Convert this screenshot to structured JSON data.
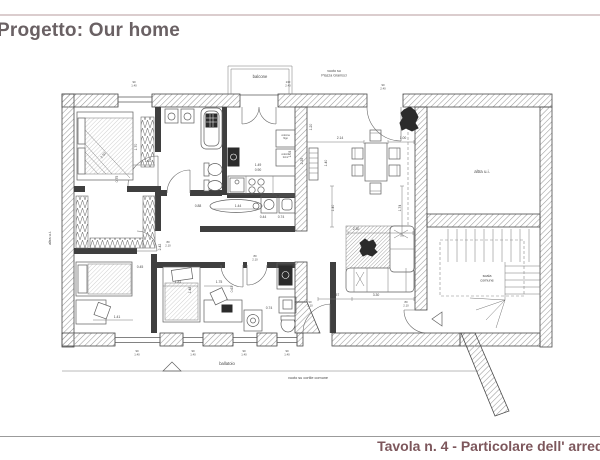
{
  "header": {
    "title": "Progetto: Our home"
  },
  "footer": {
    "title": "Tavola n. 4 - Particolare dell' arredo"
  },
  "colors": {
    "header_text": "#6a6164",
    "header_rule": "#dbcdce",
    "footer_text": "#7d575c",
    "footer_rule": "#9b9b9b",
    "plan_line": "#4a4a4a",
    "wall_fill": "#3f3f3f"
  },
  "plan": {
    "room_labels": [
      {
        "id": "balcone",
        "text": "balcone",
        "x": 260,
        "y": 78,
        "size": 4.2
      },
      {
        "id": "piazza-void",
        "text": "vuoto su\nPiazza Gramsci",
        "x": 334,
        "y": 72,
        "size": 3.6
      },
      {
        "id": "altra-ui",
        "text": "altra u.i.",
        "x": 482,
        "y": 173,
        "size": 4.4
      },
      {
        "id": "scala-comune",
        "text": "scala\ncomune",
        "x": 487,
        "y": 277,
        "size": 3.8
      },
      {
        "id": "ballatoio",
        "text": "ballatoio",
        "x": 227,
        "y": 365,
        "size": 4.2
      },
      {
        "id": "cortile-void",
        "text": "vuoto su cortile comune",
        "x": 308,
        "y": 379,
        "size": 3.8
      },
      {
        "id": "altra-ui-left",
        "text": "altra u.i.",
        "x": 51,
        "y": 238,
        "size": 3.8,
        "rot": -90
      },
      {
        "id": "colonna-frigo",
        "text": "colonna\nfrigo",
        "x": 285.5,
        "y": 136,
        "size": 2.4
      },
      {
        "id": "colonna-forno",
        "text": "colonna\nforno",
        "x": 285.5,
        "y": 155,
        "size": 2.4
      }
    ],
    "dimensions": [
      {
        "text": "2.50",
        "x": 104,
        "y": 156,
        "rot": -50
      },
      {
        "text": "1.70",
        "x": 137,
        "y": 147,
        "rot": -90
      },
      {
        "text": "0.75",
        "x": 118,
        "y": 179,
        "rot": -90
      },
      {
        "text": "1.10",
        "x": 148,
        "y": 162
      },
      {
        "text": "2.42",
        "x": 161,
        "y": 247,
        "rot": -90
      },
      {
        "text": "0.45",
        "x": 140,
        "y": 268
      },
      {
        "text": "1.41",
        "x": 117,
        "y": 318
      },
      {
        "text": "1.81",
        "x": 178,
        "y": 283
      },
      {
        "text": "1.75",
        "x": 219,
        "y": 283
      },
      {
        "text": "0.63",
        "x": 233,
        "y": 289,
        "rot": -90
      },
      {
        "text": "1.48",
        "x": 191,
        "y": 290,
        "rot": -90
      },
      {
        "text": "0.88",
        "x": 198,
        "y": 207
      },
      {
        "text": "1.44",
        "x": 238,
        "y": 207
      },
      {
        "text": "0.44",
        "x": 263,
        "y": 218
      },
      {
        "text": "0.74",
        "x": 281,
        "y": 218
      },
      {
        "text": "1.49",
        "x": 258,
        "y": 166
      },
      {
        "text": "0.90",
        "x": 258,
        "y": 171
      },
      {
        "text": "1.03",
        "x": 291,
        "y": 154,
        "rot": -90
      },
      {
        "text": "2.35",
        "x": 303,
        "y": 161,
        "rot": -90
      },
      {
        "text": "1.20",
        "x": 312,
        "y": 127,
        "rot": -90
      },
      {
        "text": "2.14",
        "x": 340,
        "y": 139
      },
      {
        "text": "1.00",
        "x": 403,
        "y": 139
      },
      {
        "text": "1.74",
        "x": 401,
        "y": 208,
        "rot": -90
      },
      {
        "text": "1.40",
        "x": 334,
        "y": 208,
        "rot": -90
      },
      {
        "text": "1.40",
        "x": 327,
        "y": 163,
        "rot": -90
      },
      {
        "text": "2.30",
        "x": 356,
        "y": 230
      },
      {
        "text": "1.57",
        "x": 336,
        "y": 296
      },
      {
        "text": "3.30",
        "x": 376,
        "y": 296
      },
      {
        "text": "0.74",
        "x": 269,
        "y": 309
      }
    ],
    "opening_tags": [
      {
        "x": 134,
        "y": 83,
        "a": "90",
        "b": "1.40"
      },
      {
        "x": 288,
        "y": 83,
        "a": "130",
        "b": "2.40"
      },
      {
        "x": 383,
        "y": 86,
        "a": "90",
        "b": "2.40"
      },
      {
        "x": 137,
        "y": 352,
        "a": "90",
        "b": "1.40"
      },
      {
        "x": 193,
        "y": 352,
        "a": "90",
        "b": "1.40"
      },
      {
        "x": 244,
        "y": 352,
        "a": "90",
        "b": "1.40"
      },
      {
        "x": 287,
        "y": 352,
        "a": "90",
        "b": "1.40"
      },
      {
        "x": 168,
        "y": 243,
        "a": "80",
        "b": "2.10"
      },
      {
        "x": 255,
        "y": 257,
        "a": "80",
        "b": "2.10"
      },
      {
        "x": 310,
        "y": 303,
        "a": "90",
        "b": "2.10"
      },
      {
        "x": 406,
        "y": 303,
        "a": "80",
        "b": "2.10"
      }
    ]
  }
}
